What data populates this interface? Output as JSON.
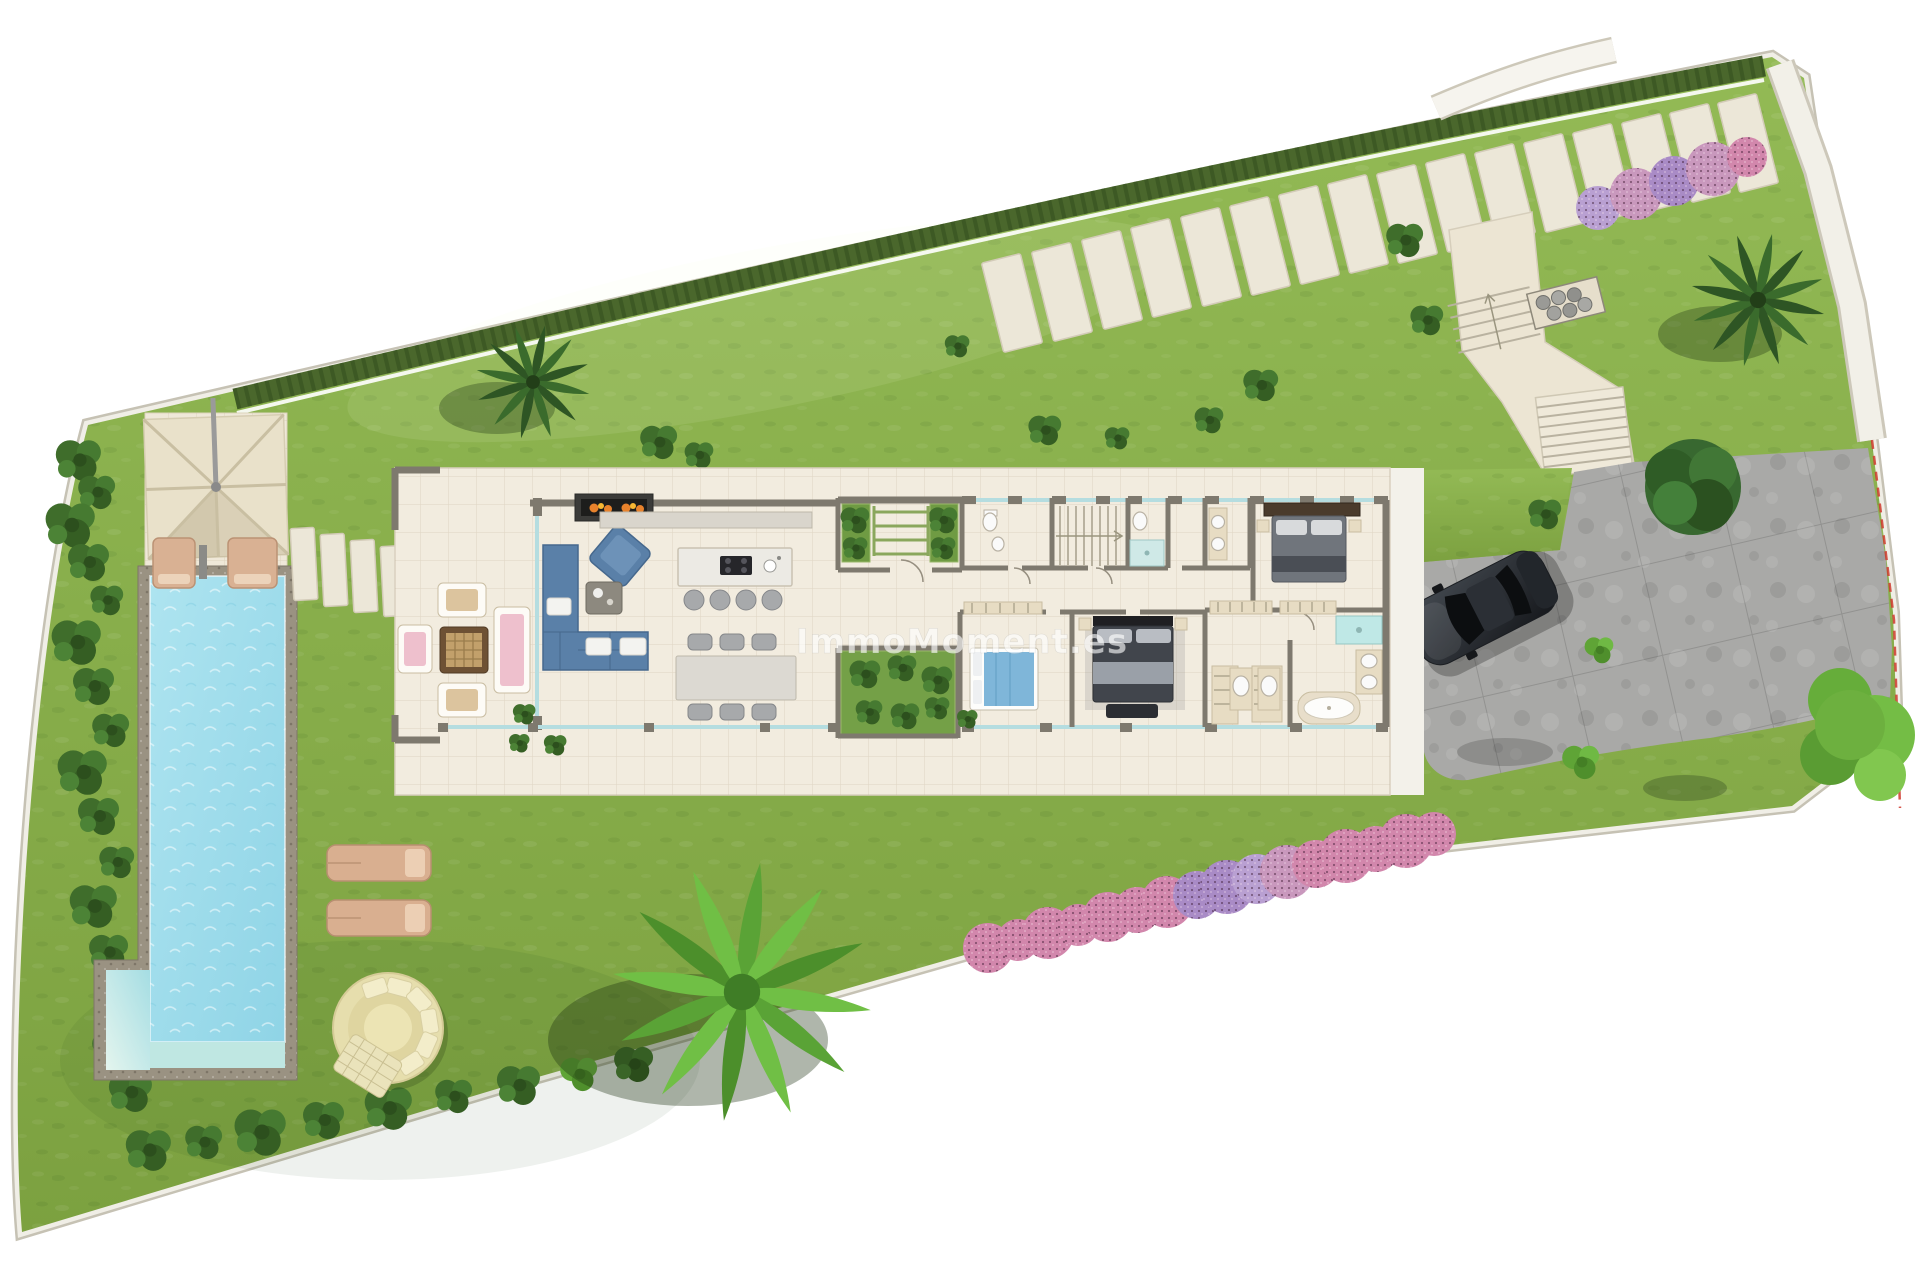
{
  "watermark": {
    "text": "ImmoMoment.es"
  },
  "palette": {
    "lawn_green": "#86ae47",
    "hedge_green": "#4a672c",
    "paving_beige": "#efe8d8",
    "pool_water_blue": "#9fdcec",
    "driveway_grey": "#a9a9a7",
    "flower_pink": "#d287ac",
    "flower_violet": "#a98bc6",
    "boundary_marker_red": "#cf3a2e",
    "car_body_dark": "#33373d",
    "sofa_blue": "#5a80a8"
  },
  "counts": {
    "top_stepping_stones": 16,
    "bottom_flower_bushes": 16,
    "top_right_flower_bushes": 5,
    "pool_sun_loungers": 2,
    "lawn_sun_loungers": 2,
    "dining_chairs": 6,
    "bar_stools": 4
  }
}
